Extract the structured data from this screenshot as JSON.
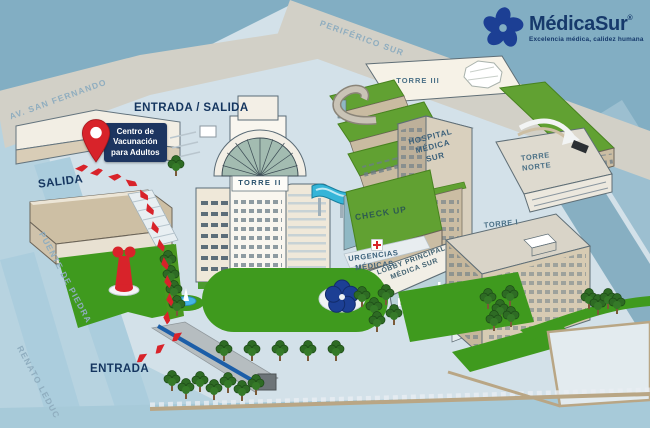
{
  "brand": {
    "name": "MédicaSur",
    "registered": "®",
    "tagline": "Excelencia médica, calidez humana",
    "logo_blue": "#1c3f94",
    "text_blue": "#16396b"
  },
  "streets": {
    "periferico_sur": "PERIFÉRICO SUR",
    "av_san_fernando": "AV. SAN FERNANDO",
    "puente_de_piedra": "PUENTE DE PIEDRA",
    "renato_leduc": "RENATO LEDUC"
  },
  "access": {
    "entrada_salida": "ENTRADA / SALIDA",
    "salida": "SALIDA",
    "entrada": "ENTRADA"
  },
  "marker": {
    "title": "Centro de\nVacunación\npara Adultos"
  },
  "buildings": {
    "torre_i": "TORRE I",
    "torre_ii": "TORRE II",
    "torre_iii": "TORRE III",
    "torre_norte": "TORRE\nNORTE",
    "hospital_medica_sur": "HOSPITAL\nMÉDICA\nSUR",
    "check_up": "CHECK UP",
    "urgencias_medicas": "URGENCIAS\nMÉDICAS",
    "lobby_principal": "LOBBY PRINCIPAL\nMÉDICA SUR"
  },
  "colors": {
    "sky": "#82aec3",
    "road_tan": "#d2d0c7",
    "ground": "#d3e1e9",
    "street_blue": "#b7d3e0",
    "lawn_green": "#3f9a1e",
    "roof_green": "#61a132",
    "navy": "#14355f",
    "red": "#d8232a",
    "badge_bg": "#1d3560"
  }
}
